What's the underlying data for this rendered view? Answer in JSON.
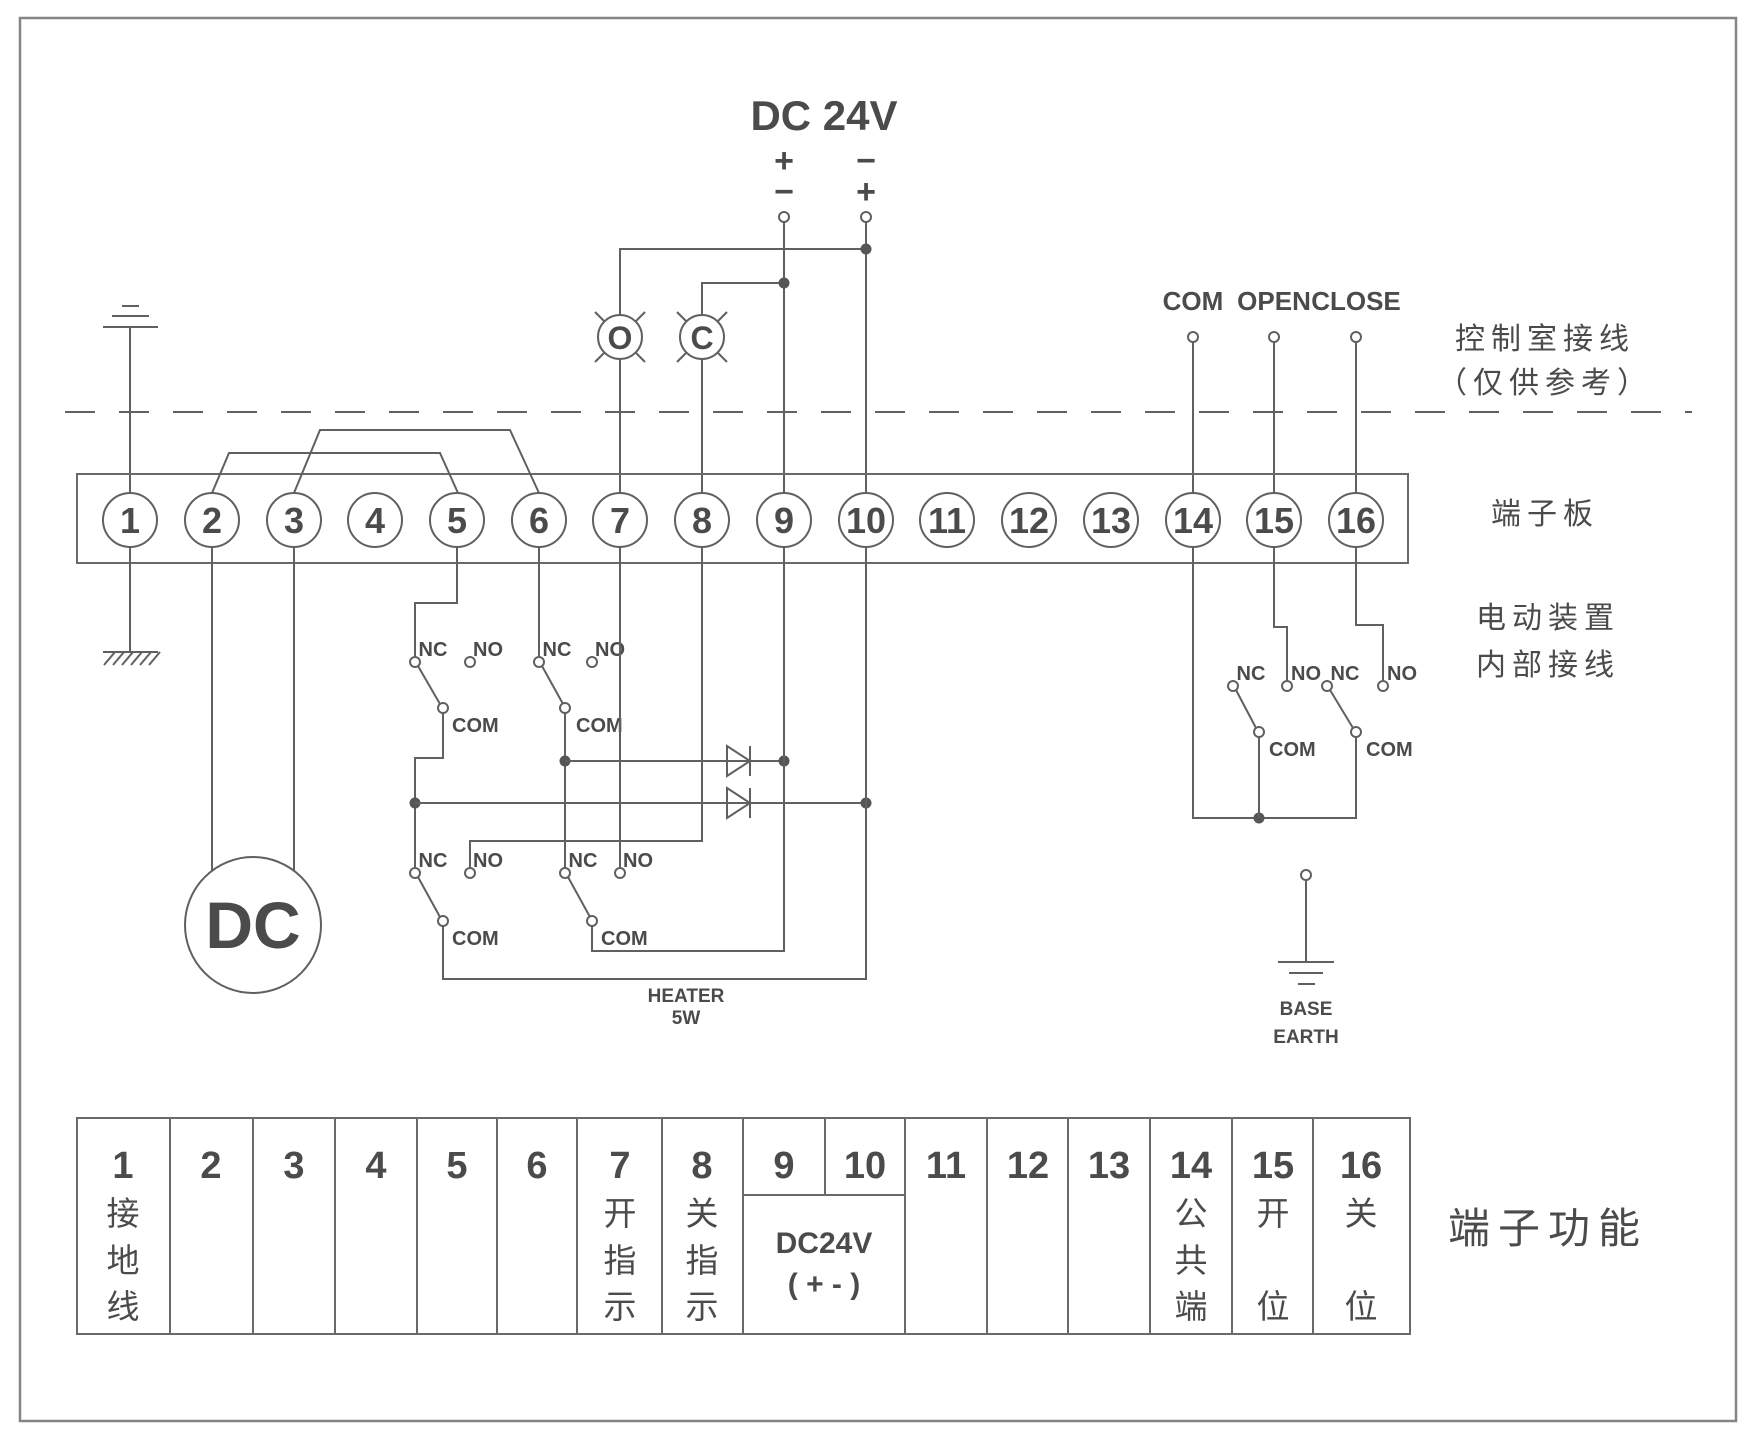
{
  "colors": {
    "line": "#606060",
    "text": "#4b4b4b",
    "background": "#ffffff"
  },
  "power": {
    "title": "DC 24V",
    "left_top": "+",
    "left_bottom": "−",
    "right_top": "−",
    "right_bottom": "+"
  },
  "control": {
    "com": "COM",
    "open": "OPEN",
    "close": "CLOSE"
  },
  "lamps": {
    "open": "O",
    "close": "C"
  },
  "switch": {
    "nc": "NC",
    "no": "NO",
    "com": "COM"
  },
  "labels": {
    "control_room_1": "控制室接线",
    "control_room_2": "（仅供参考）",
    "terminal_board": "端子板",
    "internal_1": "电动装置",
    "internal_2": "内部接线",
    "terminal_function": "端子功能",
    "heater_1": "HEATER",
    "heater_2": "5W",
    "base_earth_1": "BASE",
    "base_earth_2": "EARTH",
    "motor": "DC"
  },
  "terminals": [
    "1",
    "2",
    "3",
    "4",
    "5",
    "6",
    "7",
    "8",
    "9",
    "10",
    "11",
    "12",
    "13",
    "14",
    "15",
    "16"
  ],
  "table": {
    "columns": [
      {
        "number": "1",
        "chars": [
          "接",
          "地",
          "线"
        ]
      },
      {
        "number": "2",
        "chars": []
      },
      {
        "number": "3",
        "chars": []
      },
      {
        "number": "4",
        "chars": []
      },
      {
        "number": "5",
        "chars": []
      },
      {
        "number": "6",
        "chars": []
      },
      {
        "number": "7",
        "chars": [
          "开",
          "指",
          "示"
        ]
      },
      {
        "number": "8",
        "chars": [
          "关",
          "指",
          "示"
        ]
      },
      {
        "number": "9",
        "chars": []
      },
      {
        "number": "10",
        "chars": []
      },
      {
        "number": "11",
        "chars": []
      },
      {
        "number": "12",
        "chars": []
      },
      {
        "number": "13",
        "chars": []
      },
      {
        "number": "14",
        "chars": [
          "公",
          "共",
          "端"
        ]
      },
      {
        "number": "15",
        "chars": [
          "开",
          "位"
        ]
      },
      {
        "number": "16",
        "chars": [
          "关",
          "位"
        ]
      }
    ],
    "dc_cell": {
      "line1": "DC24V",
      "line2": "( + - )"
    }
  }
}
